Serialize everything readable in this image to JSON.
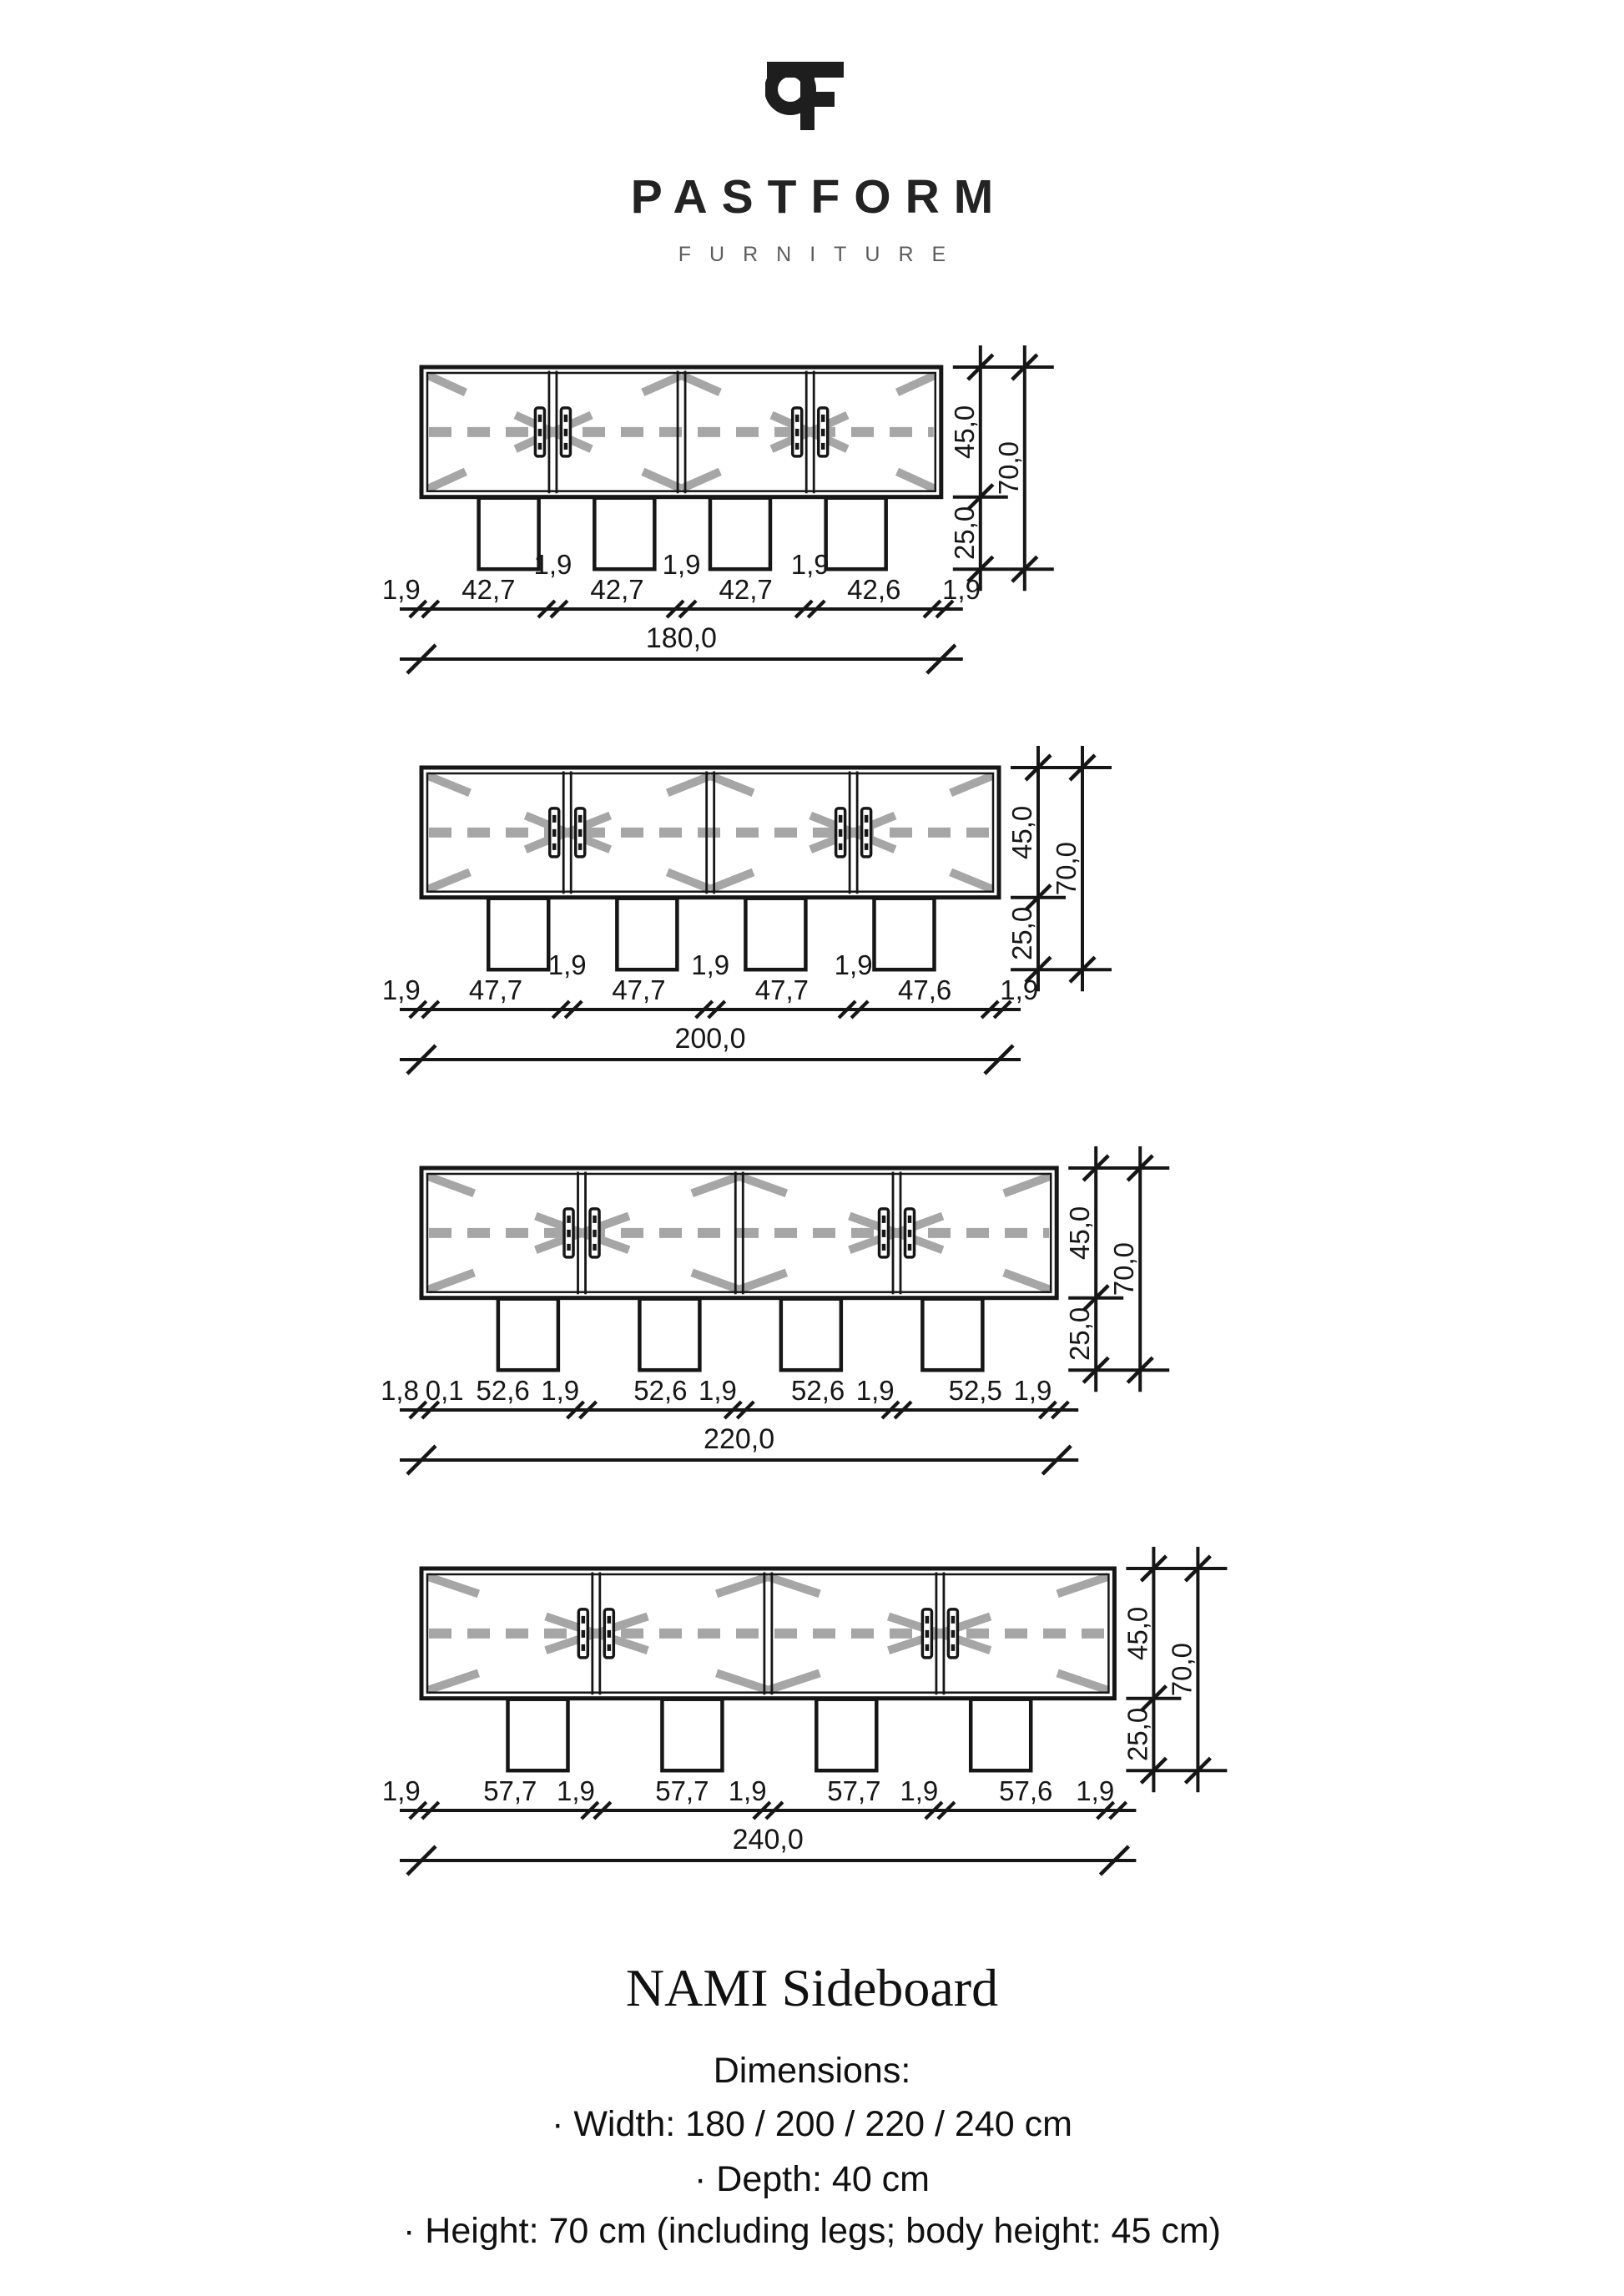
{
  "page": {
    "background": "#ffffff",
    "ink": "#161616",
    "gray": "#a6a6a6"
  },
  "logo": {
    "monogram_letters": "PF",
    "brand": "PASTFORM",
    "subtitle": "FURNITURE"
  },
  "title": "NAMI Sideboard",
  "specs": {
    "heading": "Dimensions:",
    "items": [
      "· Width: 180 / 200 / 220 / 240 cm",
      "· Depth: 40 cm",
      "· Height: 70 cm (including legs; body height: 45 cm)"
    ]
  },
  "drawings": [
    {
      "width_cm": 180,
      "total_label": "180,0",
      "side": 1.9,
      "div": 1.9,
      "comps": [
        42.7,
        42.7,
        42.7,
        42.6
      ],
      "body_cm": 45,
      "legs_cm": 25,
      "h_body": "45,0",
      "h_total": "70,0",
      "h_legs": "25,0",
      "labels": [
        {
          "t": "1,9",
          "cm": -7
        },
        {
          "t": "42,7",
          "cm": 23.25
        },
        {
          "t": "1,9",
          "cm": 45.55,
          "up": 1
        },
        {
          "t": "42,7",
          "cm": 67.85
        },
        {
          "t": "1,9",
          "cm": 90.15,
          "up": 1
        },
        {
          "t": "42,7",
          "cm": 112.45
        },
        {
          "t": "1,9",
          "cm": 134.75,
          "up": 1
        },
        {
          "t": "42,6",
          "cm": 156.9
        },
        {
          "t": "1,9",
          "cm": 187.2
        }
      ]
    },
    {
      "width_cm": 200,
      "total_label": "200,0",
      "side": 1.9,
      "div": 1.9,
      "comps": [
        47.7,
        47.7,
        47.7,
        47.6
      ],
      "body_cm": 45,
      "legs_cm": 25,
      "h_body": "45,0",
      "h_total": "70,0",
      "h_legs": "25,0",
      "labels": [
        {
          "t": "1,9",
          "cm": -7
        },
        {
          "t": "47,7",
          "cm": 25.75
        },
        {
          "t": "1,9",
          "cm": 50.55,
          "up": 1
        },
        {
          "t": "47,7",
          "cm": 75.35
        },
        {
          "t": "1,9",
          "cm": 100.15,
          "up": 1
        },
        {
          "t": "47,7",
          "cm": 124.95
        },
        {
          "t": "1,9",
          "cm": 149.75,
          "up": 1
        },
        {
          "t": "47,6",
          "cm": 174.5
        },
        {
          "t": "1,9",
          "cm": 207.2
        }
      ]
    },
    {
      "width_cm": 220,
      "total_label": "220,0",
      "side": 1.9,
      "div": 1.9,
      "comps": [
        52.6,
        52.6,
        52.6,
        52.5
      ],
      "body_cm": 45,
      "legs_cm": 25,
      "h_body": "45,0",
      "h_total": "70,0",
      "h_legs": "25,0",
      "labels": [
        {
          "t": "1,8",
          "cm": -7.5
        },
        {
          "t": "0,1",
          "cm": 8
        },
        {
          "t": "52,6",
          "cm": 28.2
        },
        {
          "t": "1,9",
          "cm": 48
        },
        {
          "t": "52,6",
          "cm": 82.7
        },
        {
          "t": "1,9",
          "cm": 102.5
        },
        {
          "t": "52,6",
          "cm": 137.2
        },
        {
          "t": "1,9",
          "cm": 157
        },
        {
          "t": "52,5",
          "cm": 191.65
        },
        {
          "t": "1,9",
          "cm": 211.5
        }
      ]
    },
    {
      "width_cm": 240,
      "total_label": "240,0",
      "side": 1.9,
      "div": 1.9,
      "comps": [
        57.7,
        57.7,
        57.7,
        57.6
      ],
      "body_cm": 45,
      "legs_cm": 25,
      "h_body": "45,0",
      "h_total": "70,0",
      "h_legs": "25,0",
      "labels": [
        {
          "t": "1,9",
          "cm": -7
        },
        {
          "t": "57,7",
          "cm": 30.75
        },
        {
          "t": "1,9",
          "cm": 53.5
        },
        {
          "t": "57,7",
          "cm": 90.35
        },
        {
          "t": "1,9",
          "cm": 113
        },
        {
          "t": "57,7",
          "cm": 149.95
        },
        {
          "t": "1,9",
          "cm": 172.5
        },
        {
          "t": "57,6",
          "cm": 209.5
        },
        {
          "t": "1,9",
          "cm": 233.5
        }
      ]
    }
  ]
}
